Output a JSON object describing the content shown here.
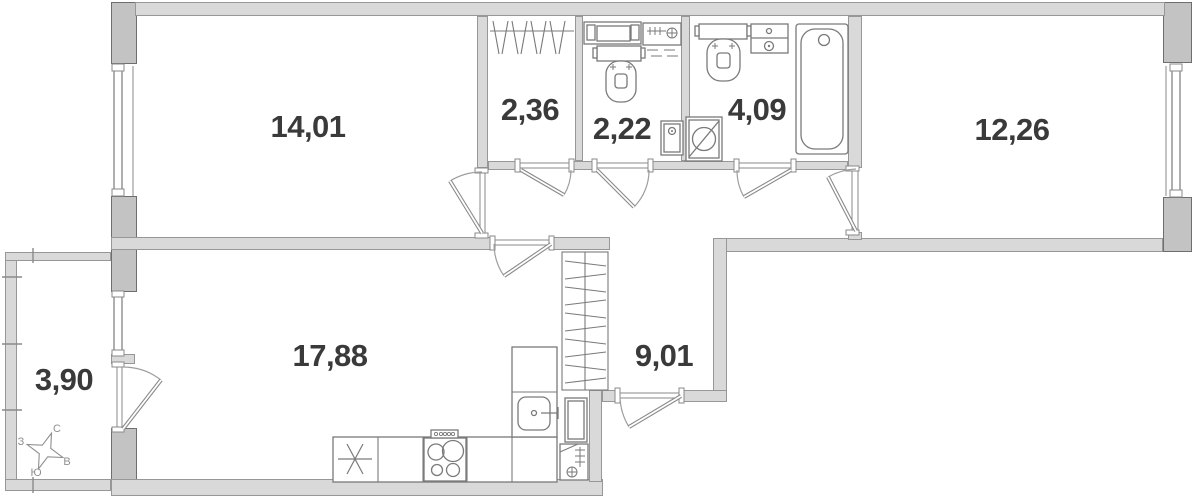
{
  "plan": {
    "rooms": [
      {
        "name": "living-room",
        "area": "14,01"
      },
      {
        "name": "wardrobe",
        "area": "2,36"
      },
      {
        "name": "wc",
        "area": "2,22"
      },
      {
        "name": "bathroom",
        "area": "4,09"
      },
      {
        "name": "bedroom",
        "area": "12,26"
      },
      {
        "name": "kitchen-living-room",
        "area": "17,88"
      },
      {
        "name": "hallway",
        "area": "9,01"
      },
      {
        "name": "balcony",
        "area": "3,90"
      }
    ],
    "compass": {
      "north": "С",
      "south": "Ю",
      "west": "З",
      "east": "В"
    },
    "colors": {
      "wall_dark": "#c3c3c3",
      "wall_light": "#d9d9d9",
      "wall_outline": "#6e6e6e",
      "line": "#7a7a7a",
      "label_text": "#3a3a3a"
    }
  }
}
